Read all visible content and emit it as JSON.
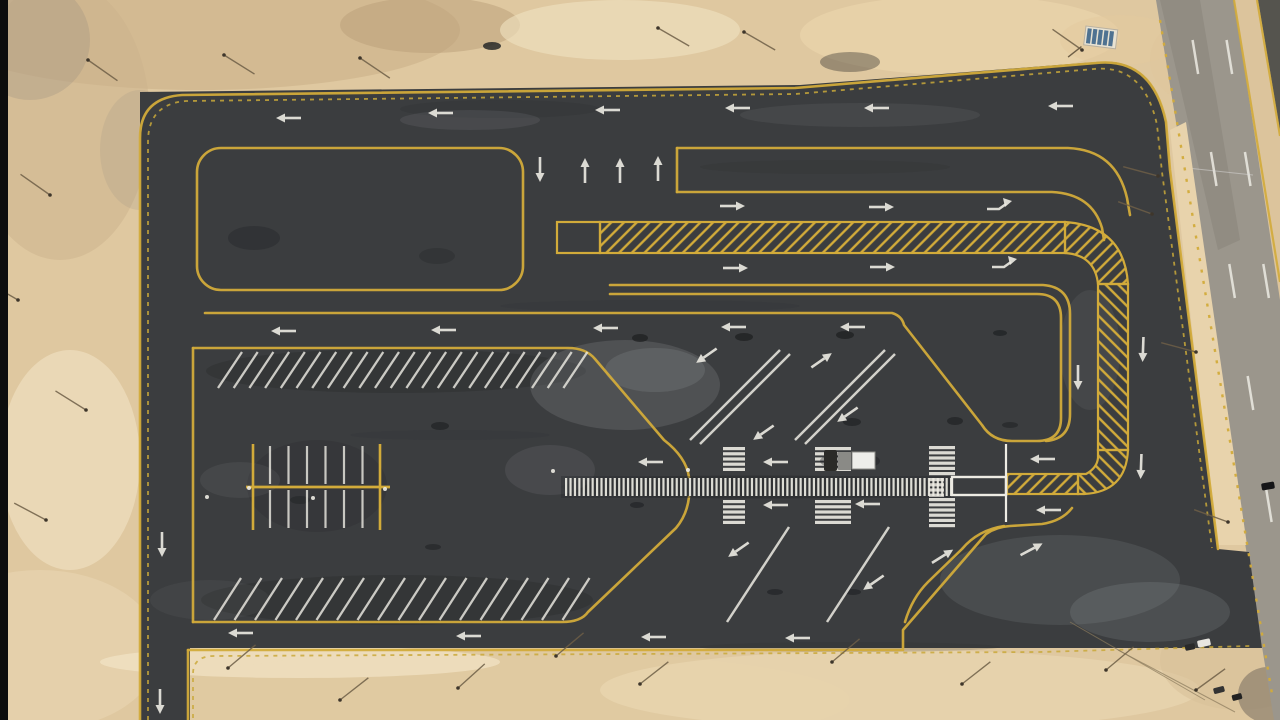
{
  "meta": {
    "alt": "Aerial photograph of a newly paved asphalt parking lot with fresh yellow lane lines, yellow chevron-hatched islands, white angled parking stripes, zebra crosswalks, a long white-barred pedestrian walkway, directional arrows and a line-marking truck, surrounded by desert sand next to a multi-lane highway running diagonally along the right edge."
  },
  "palette": {
    "sand": "#dfc8a0",
    "sandLight": "#f0e2c2",
    "sandDark": "#c9ae86",
    "asphalt": "#3b3d3f",
    "asphaltDark": "#2a2c2e",
    "road": "#9b968c",
    "shoulder": "#dcc49c",
    "farstrip": "#55544e",
    "yellow": "#d2ab3a",
    "curb": "#c9a83a",
    "white": "#edebe3",
    "black": "#0d0d0d",
    "panelBlue": "#4f7291"
  },
  "scene": {
    "blotches": [
      [
        200,
        30,
        260,
        60,
        "#c9ae86",
        0.55
      ],
      [
        60,
        120,
        90,
        140,
        "#cbb28b",
        0.5
      ],
      [
        30,
        40,
        60,
        60,
        "#9a8f80",
        0.3
      ],
      [
        140,
        150,
        40,
        60,
        "#a89a86",
        0.25
      ],
      [
        430,
        25,
        90,
        28,
        "#b99e78",
        0.5
      ],
      [
        620,
        30,
        120,
        30,
        "#f0e2c2",
        0.6
      ],
      [
        960,
        35,
        160,
        40,
        "#ecd7ae",
        0.6
      ],
      [
        1120,
        40,
        60,
        25,
        "#e3c99e",
        0.5
      ],
      [
        70,
        460,
        70,
        110,
        "#f1e3c5",
        0.6
      ],
      [
        40,
        650,
        120,
        80,
        "#e9d6b2",
        0.6
      ],
      [
        500,
        700,
        350,
        50,
        "#e2cba1",
        0.5
      ],
      [
        900,
        690,
        300,
        40,
        "#eedcb8",
        0.5
      ],
      [
        300,
        662,
        200,
        16,
        "#f2e4c6",
        0.7
      ],
      [
        1240,
        660,
        80,
        50,
        "#d9c29a",
        0.6
      ],
      [
        1268,
        695,
        30,
        28,
        "#6b6257",
        0.5
      ],
      [
        1190,
        60,
        40,
        40,
        "#e0c69c",
        0.5
      ]
    ],
    "streaks_light": [
      [
        625,
        385,
        95,
        45,
        0.16
      ],
      [
        655,
        370,
        50,
        22,
        0.14
      ],
      [
        470,
        120,
        70,
        10,
        0.1
      ],
      [
        860,
        115,
        120,
        12,
        0.08
      ],
      [
        1060,
        580,
        120,
        45,
        0.12
      ],
      [
        1150,
        612,
        80,
        30,
        0.14
      ],
      [
        550,
        470,
        45,
        25,
        0.1
      ],
      [
        240,
        480,
        40,
        18,
        0.08
      ],
      [
        1090,
        350,
        30,
        60,
        0.08
      ],
      [
        210,
        600,
        60,
        20,
        0.06
      ]
    ],
    "streaks_dark": [
      [
        500,
        109,
        100,
        9,
        0.22
      ],
      [
        825,
        167,
        125,
        7,
        0.18
      ],
      [
        650,
        306,
        150,
        6,
        0.12
      ],
      [
        850,
        647,
        150,
        5,
        0.18
      ],
      [
        450,
        435,
        100,
        5,
        0.12
      ],
      [
        396,
        371,
        190,
        22,
        0.4
      ],
      [
        397,
        600,
        196,
        25,
        0.4
      ],
      [
        317,
        486,
        70,
        46,
        0.3
      ],
      [
        757,
        487,
        196,
        12,
        0.28
      ]
    ],
    "road": {
      "edgeX": 1156,
      "slope": 0.164,
      "dash_ys": [
        40,
        152,
        264,
        376,
        488,
        600,
        688
      ],
      "dash_len": 34,
      "dash_offsets": [
        30,
        64
      ]
    },
    "markings": {
      "comb": {
        "x0": 565,
        "x1": 950,
        "y": 478,
        "h": 18,
        "n": 88,
        "w": 2.2
      },
      "stop_box": {
        "x": 952,
        "y": 477,
        "w": 54,
        "h": 18
      },
      "stop_line": {
        "x": 1006,
        "y0": 444,
        "y1": 522
      },
      "crosswalks": [
        {
          "x": 723,
          "w": 22,
          "stacks": [
            {
              "y": 447,
              "n": 5
            },
            {
              "y": 500,
              "n": 5
            }
          ]
        },
        {
          "x": 815,
          "w": 36,
          "stacks": [
            {
              "y": 447,
              "n": 5
            },
            {
              "y": 500,
              "n": 5
            }
          ]
        },
        {
          "x": 929,
          "w": 26,
          "stacks": [
            {
              "y": 446,
              "n": 6
            },
            {
              "y": 498,
              "n": 6
            }
          ],
          "mid": {
            "y": 478,
            "n": 4,
            "w": 15
          }
        }
      ],
      "bar_h": 3.2,
      "bar_pitch": 5.2,
      "stripe_rows": [
        {
          "x0": 218,
          "n": 23,
          "pitch": 15.7,
          "y0": 388,
          "dx": 24,
          "dy": -36
        },
        {
          "x0": 214,
          "n": 18,
          "pitch": 20.5,
          "y0": 620,
          "dx": 27,
          "dy": -42
        }
      ],
      "stalls": {
        "x1": 253,
        "x2": 380,
        "yTop": 444,
        "yBot": 530,
        "spineY": 487,
        "spineX1": 246,
        "spineX2": 390,
        "n": 6,
        "x0": 270,
        "pitch": 18.5,
        "stripeTop": 446,
        "stripeMid1": 484,
        "stripeMid2": 490,
        "stripeBot": 528
      },
      "diag_lines": [
        [
          690,
          440,
          780,
          350
        ],
        [
          700,
          444,
          790,
          354
        ],
        [
          795,
          440,
          885,
          350
        ],
        [
          805,
          444,
          895,
          354
        ],
        [
          727,
          622,
          789,
          527
        ],
        [
          827,
          622,
          889,
          527
        ]
      ],
      "arrows": [
        {
          "x": 288,
          "y": 118,
          "a": 180
        },
        {
          "x": 440,
          "y": 113,
          "a": 180
        },
        {
          "x": 607,
          "y": 110,
          "a": 180
        },
        {
          "x": 737,
          "y": 108,
          "a": 180
        },
        {
          "x": 876,
          "y": 108,
          "a": 180
        },
        {
          "x": 1060,
          "y": 106,
          "a": 180
        },
        {
          "x": 540,
          "y": 170,
          "a": 90
        },
        {
          "x": 585,
          "y": 170,
          "a": 270
        },
        {
          "x": 620,
          "y": 170,
          "a": 270
        },
        {
          "x": 658,
          "y": 168,
          "a": 270
        },
        {
          "x": 733,
          "y": 206,
          "a": 0
        },
        {
          "x": 882,
          "y": 207,
          "a": 0
        },
        {
          "x": 998,
          "y": 208,
          "a": 0,
          "t": "turn"
        },
        {
          "x": 736,
          "y": 268,
          "a": 0
        },
        {
          "x": 883,
          "y": 267,
          "a": 0
        },
        {
          "x": 1003,
          "y": 266,
          "a": 0,
          "t": "turn"
        },
        {
          "x": 283,
          "y": 331,
          "a": 180
        },
        {
          "x": 443,
          "y": 330,
          "a": 180
        },
        {
          "x": 605,
          "y": 328,
          "a": 180
        },
        {
          "x": 733,
          "y": 327,
          "a": 180
        },
        {
          "x": 852,
          "y": 327,
          "a": 180
        },
        {
          "x": 650,
          "y": 462,
          "a": 180
        },
        {
          "x": 775,
          "y": 462,
          "a": 180
        },
        {
          "x": 1042,
          "y": 459,
          "a": 180
        },
        {
          "x": 775,
          "y": 505,
          "a": 180
        },
        {
          "x": 867,
          "y": 504,
          "a": 180
        },
        {
          "x": 1048,
          "y": 510,
          "a": 180
        },
        {
          "x": 240,
          "y": 633,
          "a": 180
        },
        {
          "x": 468,
          "y": 636,
          "a": 180
        },
        {
          "x": 653,
          "y": 637,
          "a": 180
        },
        {
          "x": 797,
          "y": 638,
          "a": 180
        },
        {
          "x": 162,
          "y": 545,
          "a": 90
        },
        {
          "x": 160,
          "y": 702,
          "a": 90
        },
        {
          "x": 1078,
          "y": 378,
          "a": 90
        },
        {
          "x": 1143,
          "y": 350,
          "a": 92
        },
        {
          "x": 1141,
          "y": 467,
          "a": 92
        },
        {
          "x": 706,
          "y": 356,
          "a": 145
        },
        {
          "x": 822,
          "y": 360,
          "a": -35
        },
        {
          "x": 847,
          "y": 415,
          "a": 145
        },
        {
          "x": 763,
          "y": 433,
          "a": 145
        },
        {
          "x": 738,
          "y": 550,
          "a": 145
        },
        {
          "x": 873,
          "y": 583,
          "a": 145
        },
        {
          "x": 943,
          "y": 556,
          "a": -32
        },
        {
          "x": 1032,
          "y": 549,
          "a": -28
        }
      ],
      "paint_dots": [
        [
          207,
          497
        ],
        [
          249,
          488
        ],
        [
          313,
          498
        ],
        [
          385,
          489
        ],
        [
          688,
          470
        ],
        [
          553,
          471
        ]
      ],
      "road_crack": [
        1178,
        167,
        1253,
        175
      ]
    },
    "objects": {
      "truck": {
        "x": 824,
        "y": 447
      },
      "solar_panel": {
        "x": 1086,
        "y": 26,
        "w": 32,
        "h": 19,
        "rot": 7,
        "stripes": 5
      },
      "cars": [
        {
          "x": 1204,
          "y": 643,
          "w": 13,
          "h": 7,
          "c": "#e8e6e0",
          "rot": -12
        },
        {
          "x": 1190,
          "y": 647,
          "w": 10,
          "h": 6,
          "c": "#2a2a2a",
          "rot": -12
        },
        {
          "x": 1219,
          "y": 690,
          "w": 11,
          "h": 6,
          "c": "#333333",
          "rot": -15
        },
        {
          "x": 1237,
          "y": 697,
          "w": 10,
          "h": 6,
          "c": "#222222",
          "rot": -15
        },
        {
          "x": 1268,
          "y": 486,
          "w": 13,
          "h": 7,
          "c": "#151517",
          "rot": -10
        }
      ],
      "blobs": [
        [
          640,
          338,
          8,
          4,
          0.7
        ],
        [
          744,
          337,
          9,
          4,
          0.7
        ],
        [
          845,
          335,
          9,
          4,
          0.7
        ],
        [
          1000,
          333,
          7,
          3,
          0.65
        ],
        [
          852,
          422,
          9,
          4,
          0.6
        ],
        [
          955,
          421,
          8,
          4,
          0.6
        ],
        [
          440,
          426,
          9,
          4,
          0.6
        ],
        [
          637,
          505,
          7,
          3,
          0.55
        ],
        [
          775,
          592,
          8,
          3,
          0.55
        ],
        [
          853,
          592,
          8,
          3,
          0.55
        ],
        [
          433,
          547,
          8,
          3,
          0.5
        ],
        [
          254,
          238,
          26,
          12,
          0.3
        ],
        [
          437,
          256,
          18,
          8,
          0.25
        ],
        [
          850,
          62,
          30,
          10,
          0.35
        ],
        [
          492,
          46,
          9,
          4,
          0.8
        ],
        [
          300,
          500,
          10,
          4,
          0.4
        ],
        [
          1010,
          425,
          8,
          3,
          0.5
        ]
      ],
      "poles": [
        [
          88,
          60,
          35
        ],
        [
          224,
          55,
          32
        ],
        [
          360,
          58,
          34
        ],
        [
          658,
          28,
          30
        ],
        [
          744,
          32,
          30
        ],
        [
          50,
          195,
          215
        ],
        [
          18,
          300,
          210
        ],
        [
          86,
          410,
          212
        ],
        [
          46,
          520,
          208
        ],
        [
          228,
          668,
          -40
        ],
        [
          340,
          700,
          -38
        ],
        [
          458,
          688,
          -42
        ],
        [
          556,
          656,
          -40
        ],
        [
          640,
          684,
          -38
        ],
        [
          832,
          662,
          -40
        ],
        [
          962,
          684,
          -38
        ],
        [
          1106,
          670,
          -40
        ],
        [
          1196,
          690,
          -36
        ],
        [
          1158,
          176,
          195
        ],
        [
          1152,
          214,
          200
        ],
        [
          1196,
          352,
          195
        ],
        [
          1228,
          522,
          200
        ],
        [
          1082,
          50,
          215
        ]
      ],
      "wires": [
        [
          1070,
          622,
          1205,
          700
        ],
        [
          1118,
          650,
          1235,
          712
        ]
      ]
    }
  }
}
